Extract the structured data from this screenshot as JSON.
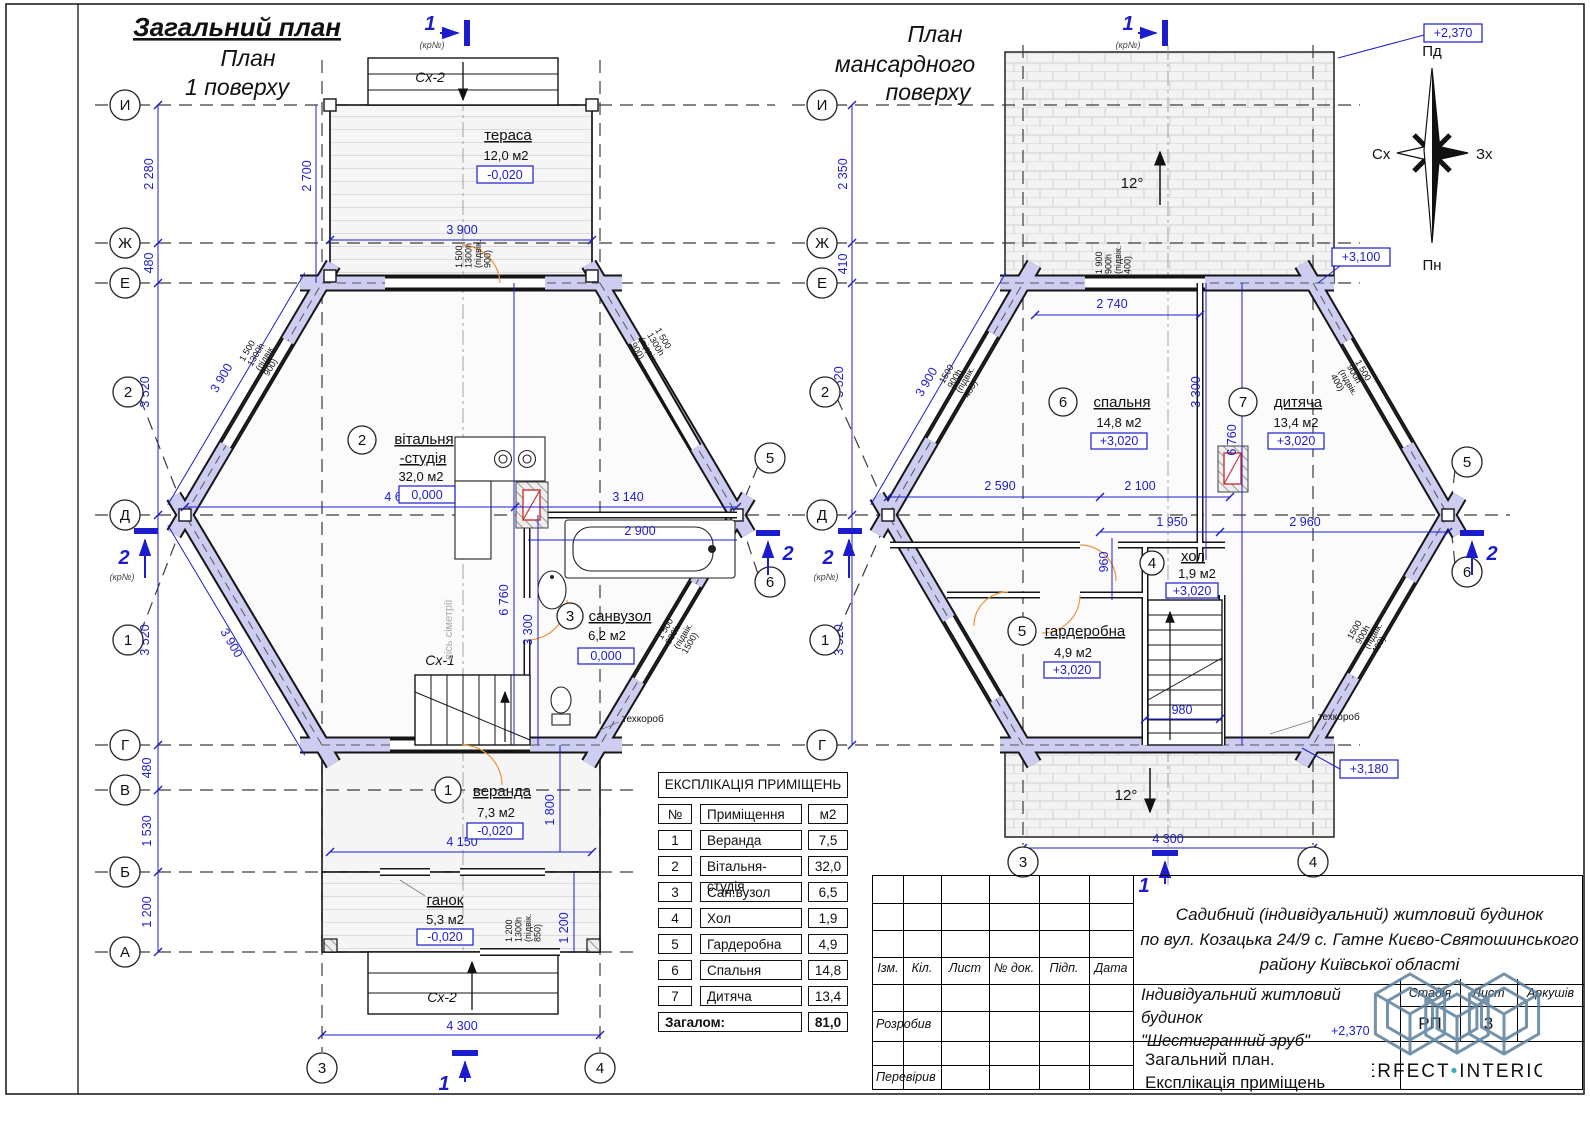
{
  "titles": {
    "left1": "Загальний план",
    "left2": "План",
    "left3": "1 поверху",
    "right1": "План",
    "right2": "мансардного",
    "right3": "поверху"
  },
  "compass": {
    "top": "Пд",
    "bottom": "Пн",
    "left": "Сх",
    "right": "Зх"
  },
  "axes": {
    "i": "И",
    "zh": "Ж",
    "e": "Е",
    "d": "Д",
    "g": "Г",
    "v": "В",
    "b": "Б",
    "a": "А",
    "n1": "1",
    "n2": "2",
    "n3": "3",
    "n4": "4",
    "n5": "5",
    "n6": "6"
  },
  "sections": {
    "s1": "1",
    "s2": "2",
    "kr": "(кр№)"
  },
  "misc": {
    "sx1": "Сх-1",
    "sx2": "Сх-2",
    "sym_axis": "вісь сіметрії",
    "tehkorob": "техкороб",
    "slope": "12°"
  },
  "left_plan": {
    "rooms": {
      "terrace": {
        "name": "тераса",
        "area": "12,0 м2",
        "lvl": "-0,020"
      },
      "living": {
        "num": "2",
        "name1": "вітальня",
        "name2": "-студія",
        "area": "32,0 м2",
        "lvl": "0,000"
      },
      "bath": {
        "num": "3",
        "name": "санвузол",
        "area": "6,2 м2",
        "lvl": "0,000"
      },
      "veranda": {
        "num": "1",
        "name": "веранда",
        "area": "7,3 м2",
        "lvl": "-0,020"
      },
      "porch": {
        "name": "ганок",
        "area": "5,3 м2",
        "lvl": "-0,020"
      }
    },
    "dims": {
      "v1": "2 280",
      "v2": "480",
      "v3": "3 520",
      "v4": "3 520",
      "v5": "480",
      "v6": "1 530",
      "v7": "1 200",
      "t1": "2 700",
      "t2": "3 900",
      "diag1": "3 900",
      "diag2": "3 900",
      "h1": "4 660",
      "h2": "3 140",
      "h3": "2 900",
      "h4": "6 760",
      "h5": "3 300",
      "h6": "4 150",
      "h7": "1 800",
      "h8": "1 200",
      "h9": "4 300"
    },
    "wtags": {
      "top": {
        "l1": "1 500",
        "l2": "1300h",
        "l3": "(підвік.",
        "l4": "900)"
      },
      "ul": {
        "l1": "1 500",
        "l2": "1300h",
        "l3": "(підвік.",
        "l4": "900)"
      },
      "ur": {
        "l1": "1 500",
        "l2": "1300h",
        "l3": "(підвік.",
        "l4": "900)"
      },
      "lr": {
        "l1": "1 500",
        "l2": "900h",
        "l3": "(підвік.",
        "l4": "1500)"
      },
      "porch": {
        "l1": "1 200",
        "l2": "1300h",
        "l3": "(підвік.",
        "l4": "850)"
      }
    }
  },
  "right_plan": {
    "rooms": {
      "bedroom": {
        "num": "6",
        "name": "спальня",
        "area": "14,8 м2",
        "lvl": "+3,020"
      },
      "child": {
        "num": "7",
        "name": "дитяча",
        "area": "13,4 м2",
        "lvl": "+3,020"
      },
      "hall": {
        "num": "4",
        "name": "хол",
        "area": "1,9 м2",
        "lvl": "+3,020"
      },
      "wardrobe": {
        "num": "5",
        "name": "гардеробна",
        "area": "4,9 м2",
        "lvl": "+3,020"
      }
    },
    "dims": {
      "v1": "2 350",
      "v2": "410",
      "v3": "3 520",
      "v4": "3 520",
      "diag": "3 900",
      "h1": "2 740",
      "h2": "3 300",
      "h3": "6 760",
      "h4": "2 590",
      "h5": "2 100",
      "h6": "1 950",
      "h7": "2 960",
      "h8": "960",
      "h9": "980",
      "h10": "4 300"
    },
    "elev": {
      "e1": "+2,370",
      "e2": "+3,100",
      "e3": "+3,180"
    },
    "wtags": {
      "top": {
        "l1": "1 900",
        "l2": "900h",
        "l3": "(підвік.",
        "l4": "400)"
      },
      "ul": {
        "l1": "1500",
        "l2": "900h",
        "l3": "(підвік.",
        "l4": "400)"
      },
      "ur": {
        "l1": "1 500",
        "l2": "900h",
        "l3": "(підвік.",
        "l4": "400)"
      },
      "lr": {
        "l1": "1500",
        "l2": "900h",
        "l3": "(підвік.",
        "l4": "400)"
      }
    }
  },
  "explication": {
    "title": "ЕКСПЛІКАЦІЯ ПРИМІЩЕНЬ",
    "col_no": "№",
    "col_name": "Приміщення",
    "col_area": "м2",
    "rows": [
      {
        "no": "1",
        "name": "Веранда",
        "area": "7,5"
      },
      {
        "no": "2",
        "name": "Вітальня-студія",
        "area": "32,0"
      },
      {
        "no": "3",
        "name": "Сан.вузол",
        "area": "6,5"
      },
      {
        "no": "4",
        "name": "Хол",
        "area": "1,9"
      },
      {
        "no": "5",
        "name": "Гардеробна",
        "area": "4,9"
      },
      {
        "no": "6",
        "name": "Спальня",
        "area": "14,8"
      },
      {
        "no": "7",
        "name": "Дитяча",
        "area": "13,4"
      }
    ],
    "total_label": "Загалом:",
    "total": "81,0"
  },
  "title_block": {
    "cols": {
      "c1": "Ізм.",
      "c2": "Кіл.",
      "c3": "Лист",
      "c4": "№ док.",
      "c5": "Підп.",
      "c6": "Дата"
    },
    "row_dev": "Розробив",
    "row_check": "Перевірив",
    "address1": "Садибний (індивідуальний) житловий будинок",
    "address2": "по вул. Козацька 24/9 с. Гатне Києво-Святошинського",
    "address3": "району Київської області",
    "object1": "Індивідуальний житловий будинок",
    "object2": "\"Шестигранний зруб\"",
    "object_lvl": "+2,370",
    "stage_label": "Стадія",
    "sheet_label": "Лист",
    "sheets_label": "Аркушів",
    "stage": "РП",
    "sheet": "3",
    "doc1": "Загальний план.",
    "doc2": "Експлікація приміщень"
  },
  "logo": {
    "part1": "PERFECT",
    "dot": "•",
    "part2": "INTERIOR"
  }
}
